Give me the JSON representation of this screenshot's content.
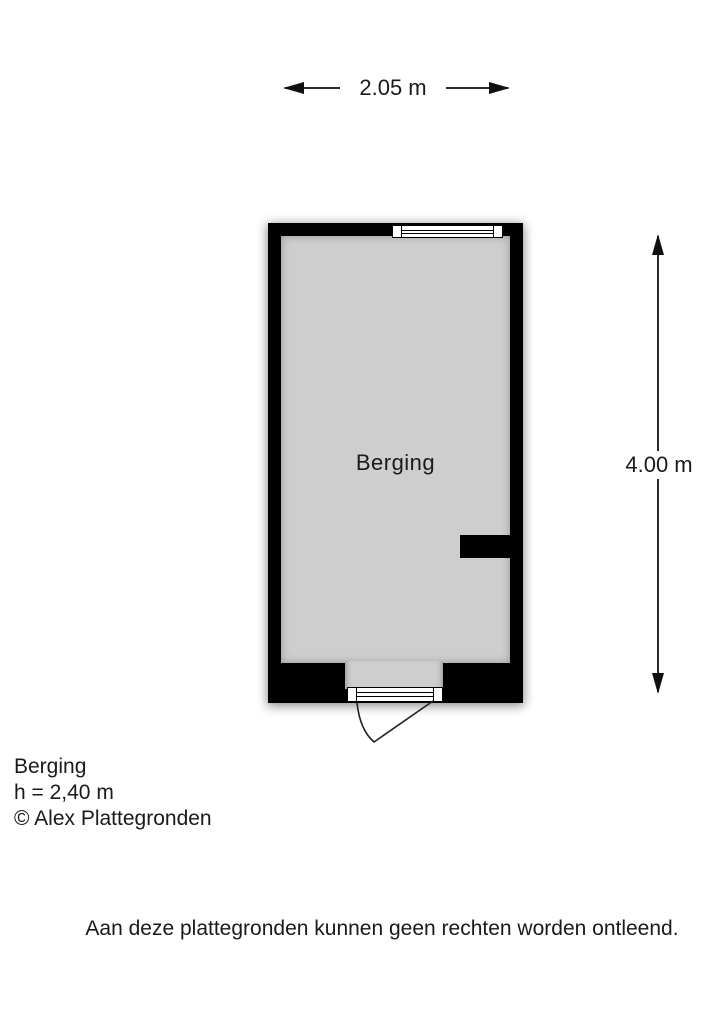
{
  "dimensions": {
    "width_label": "2.05 m",
    "height_label": "4.00 m"
  },
  "room": {
    "label": "Berging"
  },
  "legend": {
    "room_name": "Berging",
    "ceiling_height": "h = 2,40 m",
    "copyright": "© Alex Plattegronden"
  },
  "disclaimer": "Aan deze plattegronden kunnen geen rechten worden ontleend.",
  "colors": {
    "wall": "#000000",
    "floor": "#cecece",
    "line": "#2b2b2b",
    "text": "#1a1a1a"
  }
}
